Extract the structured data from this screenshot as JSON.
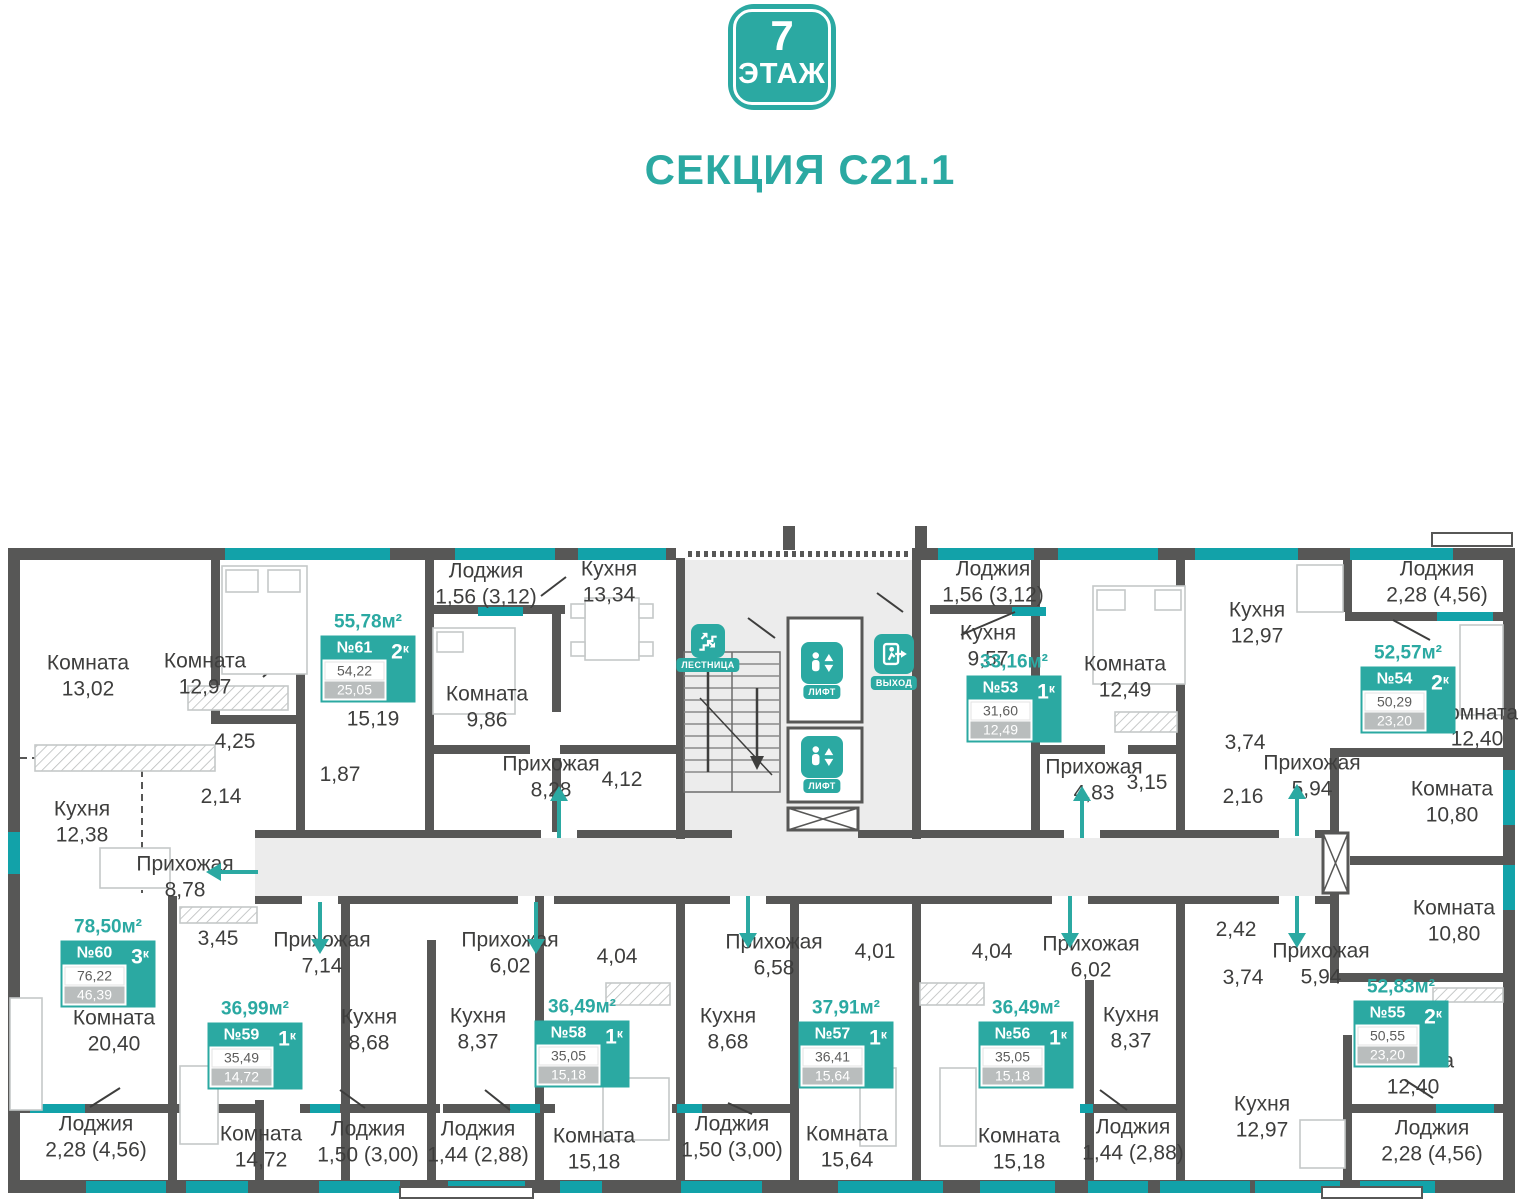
{
  "header": {
    "floor_number": "7",
    "floor_word": "ЭТАЖ",
    "section_title": "СЕКЦИЯ C21.1"
  },
  "colors": {
    "accent": "#2BA9A2",
    "window": "#12A2A9",
    "wall": "#575756",
    "corridor_fill": "#ECECEC",
    "muted_value_bg": "#B9BDBD",
    "text": "#3E3E3D"
  },
  "core": {
    "stairs_label": "ЛЕСТНИЦА",
    "lift1_label": "ЛИФТ",
    "lift2_label": "ЛИФТ",
    "exit_label": "ВЫХОД"
  },
  "apartments": [
    {
      "number": "№61",
      "rooms_count": "2",
      "rooms_suffix": "к",
      "total_area": "55,78м²",
      "living_area": "54,22",
      "second_area": "25,05"
    },
    {
      "number": "№60",
      "rooms_count": "3",
      "rooms_suffix": "к",
      "total_area": "78,50м²",
      "living_area": "76,22",
      "second_area": "46,39"
    },
    {
      "number": "№59",
      "rooms_count": "1",
      "rooms_suffix": "к",
      "total_area": "36,99м²",
      "living_area": "35,49",
      "second_area": "14,72"
    },
    {
      "number": "№58",
      "rooms_count": "1",
      "rooms_suffix": "к",
      "total_area": "36,49м²",
      "living_area": "35,05",
      "second_area": "15,18"
    },
    {
      "number": "№57",
      "rooms_count": "1",
      "rooms_suffix": "к",
      "total_area": "37,91м²",
      "living_area": "36,41",
      "second_area": "15,64"
    },
    {
      "number": "№56",
      "rooms_count": "1",
      "rooms_suffix": "к",
      "total_area": "36,49м²",
      "living_area": "35,05",
      "second_area": "15,18"
    },
    {
      "number": "№53",
      "rooms_count": "1",
      "rooms_suffix": "к",
      "total_area": "33,16м²",
      "living_area": "31,60",
      "second_area": "12,49"
    },
    {
      "number": "№54",
      "rooms_count": "2",
      "rooms_suffix": "к",
      "total_area": "52,57м²",
      "living_area": "50,29",
      "second_area": "23,20"
    },
    {
      "number": "№55",
      "rooms_count": "2",
      "rooms_suffix": "к",
      "total_area": "52,83м²",
      "living_area": "50,55",
      "second_area": "23,20"
    }
  ],
  "rooms": [
    {
      "name": "Комната",
      "value": "13,02"
    },
    {
      "name": "Комната",
      "value": "12,97"
    },
    {
      "name": "Комната",
      "value": "15,19"
    },
    {
      "name": "Комната",
      "value": "9,86"
    },
    {
      "name": "Лоджия",
      "value": "1,56 (3,12)"
    },
    {
      "name": "Кухня",
      "value": "13,34"
    },
    {
      "name": "Прихожая",
      "value": "8,28"
    },
    {
      "name": "",
      "value": "4,12"
    },
    {
      "name": "",
      "value": "1,87"
    },
    {
      "name": "",
      "value": "2,14"
    },
    {
      "name": "",
      "value": "4,25"
    },
    {
      "name": "Кухня",
      "value": "12,38"
    },
    {
      "name": "Прихожая",
      "value": "8,78"
    },
    {
      "name": "",
      "value": "3,45"
    },
    {
      "name": "Комната",
      "value": "20,40"
    },
    {
      "name": "Лоджия",
      "value": "2,28 (4,56)"
    },
    {
      "name": "Комната",
      "value": "14,72"
    },
    {
      "name": "Прихожая",
      "value": "7,14"
    },
    {
      "name": "Кухня",
      "value": "8,68"
    },
    {
      "name": "Лоджия",
      "value": "1,50 (3,00)"
    },
    {
      "name": "Кухня",
      "value": "8,37"
    },
    {
      "name": "Лоджия",
      "value": "1,44 (2,88)"
    },
    {
      "name": "Прихожая",
      "value": "6,02"
    },
    {
      "name": "Комната",
      "value": "15,18"
    },
    {
      "name": "",
      "value": "4,04"
    },
    {
      "name": "Кухня",
      "value": "8,68"
    },
    {
      "name": "Прихожая",
      "value": "6,58"
    },
    {
      "name": "Лоджия",
      "value": "1,50 (3,00)"
    },
    {
      "name": "Комната",
      "value": "15,64"
    },
    {
      "name": "",
      "value": "4,01"
    },
    {
      "name": "",
      "value": "4,04"
    },
    {
      "name": "Прихожая",
      "value": "6,02"
    },
    {
      "name": "Кухня",
      "value": "8,37"
    },
    {
      "name": "Комната",
      "value": "15,18"
    },
    {
      "name": "Лоджия",
      "value": "1,44 (2,88)"
    },
    {
      "name": "Кухня",
      "value": "9,57"
    },
    {
      "name": "Комната",
      "value": "12,49"
    },
    {
      "name": "Лоджия",
      "value": "1,56 (3,12)"
    },
    {
      "name": "Прихожая",
      "value": "4,83"
    },
    {
      "name": "",
      "value": "3,15"
    },
    {
      "name": "Кухня",
      "value": "12,97"
    },
    {
      "name": "Лоджия",
      "value": "2,28 (4,56)"
    },
    {
      "name": "Комната",
      "value": "12,40"
    },
    {
      "name": "",
      "value": "3,74"
    },
    {
      "name": "",
      "value": "2,16"
    },
    {
      "name": "Прихожая",
      "value": "5,94"
    },
    {
      "name": "Комната",
      "value": "10,80"
    },
    {
      "name": "Комната",
      "value": "10,80"
    },
    {
      "name": "",
      "value": "2,42"
    },
    {
      "name": "",
      "value": "3,74"
    },
    {
      "name": "Прихожая",
      "value": "5,94"
    },
    {
      "name": "Комната",
      "value": "12,40"
    },
    {
      "name": "Кухня",
      "value": "12,97"
    },
    {
      "name": "Лоджия",
      "value": "2,28 (4,56)"
    }
  ]
}
